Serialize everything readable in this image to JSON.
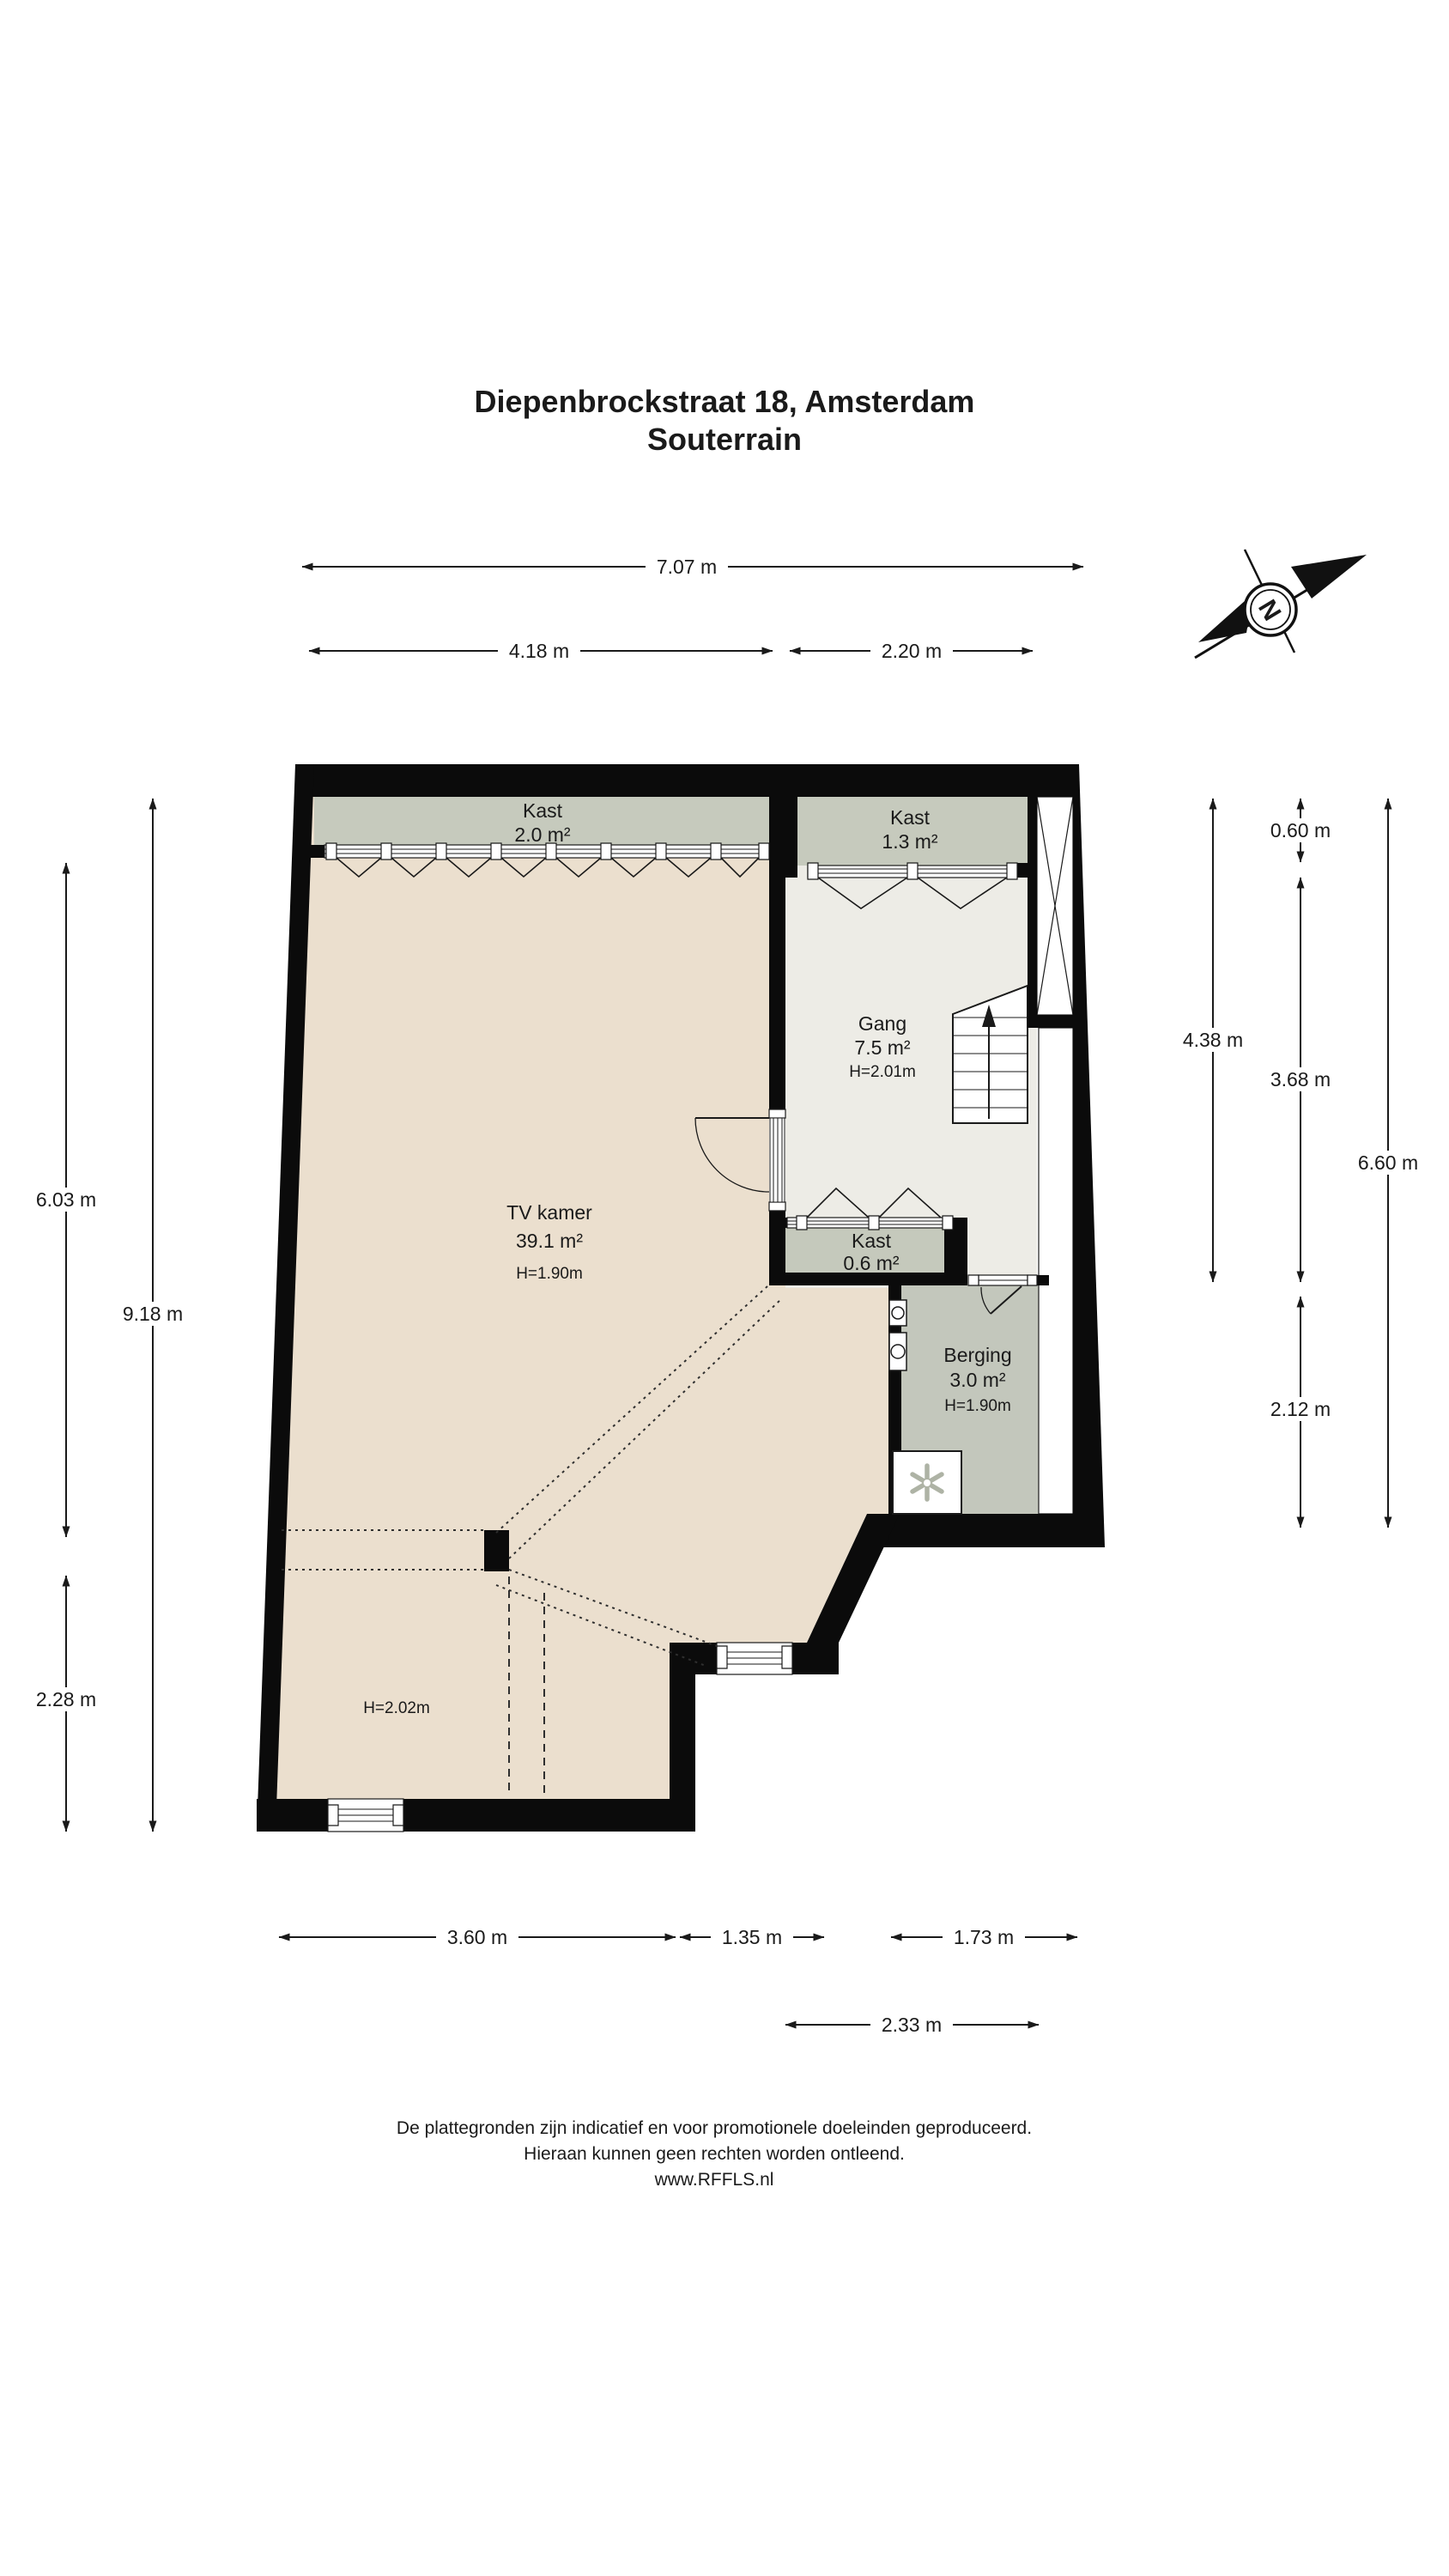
{
  "title": {
    "line1": "Diepenbrockstraat 18, Amsterdam",
    "line2": "Souterrain"
  },
  "compass": {
    "north_label": "N"
  },
  "rooms": {
    "kast_boven": {
      "name": "Kast",
      "area": "2.0 m²"
    },
    "kast_gang": {
      "name": "Kast",
      "area": "1.3 m²"
    },
    "gang": {
      "name": "Gang",
      "area": "7.5 m²",
      "height": "H=2.01m"
    },
    "tv_kamer": {
      "name": "TV kamer",
      "area": "39.1 m²",
      "height": "H=1.90m"
    },
    "kast_klein": {
      "name": "Kast",
      "area": "0.6 m²"
    },
    "berging": {
      "name": "Berging",
      "area": "3.0 m²",
      "height": "H=1.90m"
    },
    "lower_room": {
      "height": "H=2.02m"
    }
  },
  "dimensions": {
    "top_total": "7.07 m",
    "top_left": "4.18 m",
    "top_right": "2.20 m",
    "left_upper": "6.03 m",
    "left_total": "9.18 m",
    "left_lower": "2.28 m",
    "right_upper": "4.38 m",
    "right_top": "0.60 m",
    "right_middle": "3.68 m",
    "right_lower": "2.12 m",
    "right_total": "6.60 m",
    "bottom_left": "3.60 m",
    "bottom_middle": "1.35 m",
    "bottom_right": "1.73 m",
    "bottom_offset": "2.33 m"
  },
  "footer": {
    "line1": "De plattegronden zijn indicatief en voor promotionele doeleinden geproduceerd.",
    "line2": "Hieraan kunnen geen rechten worden ontleend.",
    "line3": "www.RFFLS.nl"
  },
  "colors": {
    "wall": "#0b0b0b",
    "floor_tv": "#EBDFCE",
    "floor_hall": "#EDECE6",
    "floor_closet": "#C6CABD",
    "floor_closet_small": "#C5C9BC",
    "floor_storage": "#C3C7BC",
    "white": "#FFFFFF"
  }
}
